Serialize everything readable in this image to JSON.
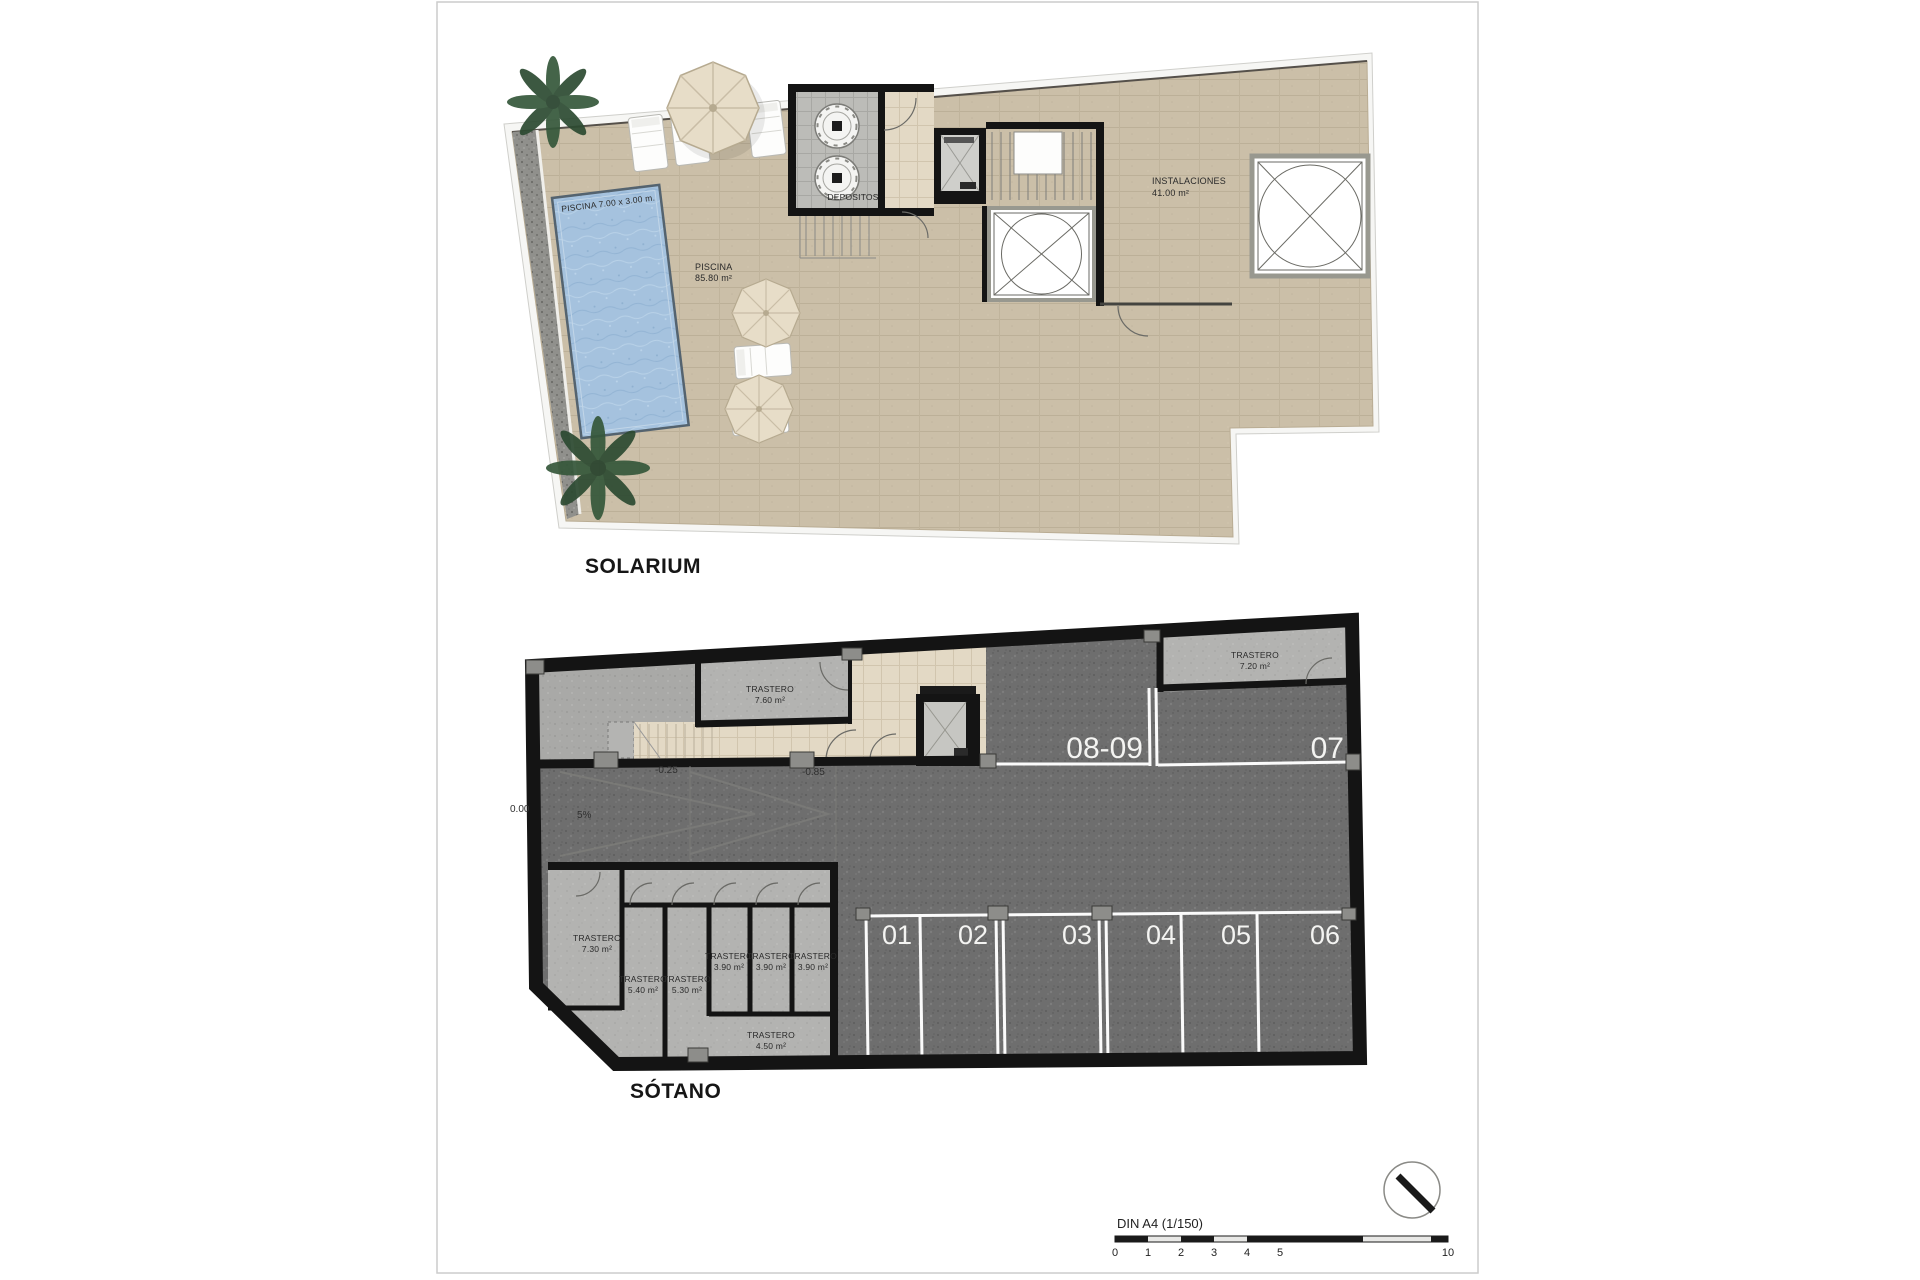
{
  "sheet": {
    "format_note": "architectural plan sheet",
    "border_color": "#cccccc",
    "background": "#ffffff"
  },
  "solarium": {
    "caption": "SOLARIUM",
    "pool": {
      "dim_label": "PISCINA 7.00 x 3.00 m.",
      "name": "PISCINA",
      "area": "85.80 m²"
    },
    "depositos_label": "DEPOSITOS",
    "instalaciones": {
      "name": "INSTALACIONES",
      "area": "41.00 m²"
    }
  },
  "sotano": {
    "caption": "SÓTANO",
    "levels": {
      "street": "0.00",
      "slope": "5%",
      "mid": "-0.25",
      "lower": "-0.85"
    },
    "parking": {
      "spots": [
        "01",
        "02",
        "03",
        "04",
        "05",
        "06"
      ],
      "spot_single": "07",
      "spot_double": "08-09"
    },
    "trasteros": {
      "t760": {
        "name": "TRASTERO",
        "area": "7.60 m²"
      },
      "t720": {
        "name": "TRASTERO",
        "area": "7.20 m²"
      },
      "t730": {
        "name": "TRASTERO",
        "area": "7.30 m²"
      },
      "t540": {
        "name": "TRASTERO",
        "area": "5.40 m²"
      },
      "t530": {
        "name": "TRASTERO",
        "area": "5.30 m²"
      },
      "t390a": {
        "name": "TRASTERO",
        "area": "3.90 m²"
      },
      "t390b": {
        "name": "TRASTERO",
        "area": "3.90 m²"
      },
      "t390c": {
        "name": "TRASTERO",
        "area": "3.90 m²"
      },
      "t450": {
        "name": "TRASTERO",
        "area": "4.50 m²"
      }
    }
  },
  "footer": {
    "scale_title": "DIN A4 (1/150)",
    "ticks": [
      "0",
      "1",
      "2",
      "3",
      "4",
      "5"
    ],
    "tick_end": "10"
  },
  "colors": {
    "wall": "#141414",
    "terrace_tile": "#cbbfa8",
    "hall_tile": "#e3d9c5",
    "parking_floor": "#6e6e6e",
    "storage_floor": "#b3b3b1",
    "ramp_floor": "#a9a9a7",
    "pool_water": "#a5c2de",
    "gravel": "#90908c",
    "parking_line": "#fbfbfb",
    "parasol": "#e7ddc8",
    "plant": "#35573a"
  }
}
